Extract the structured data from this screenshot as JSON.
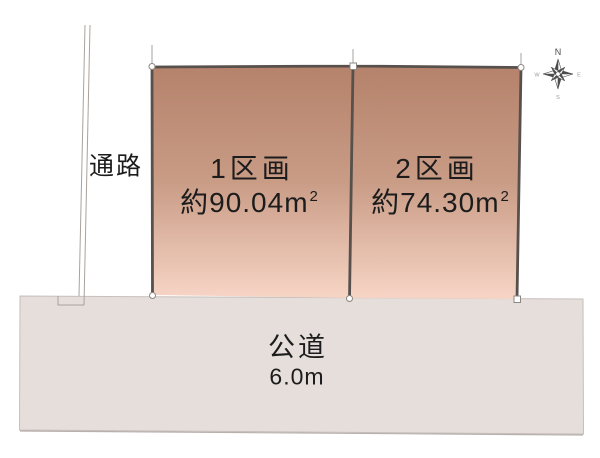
{
  "colors": {
    "background": "#ffffff",
    "plot_top": "#b5826b",
    "plot_mid": "#c99c86",
    "plot_bottom": "#f7d5c6",
    "plot_border": "#57504c",
    "road_fill": "#e5dedb",
    "road_edge": "#c6bfbc",
    "road_shadow": "#b7b0ad",
    "line_light": "#a9a29d",
    "marker_stroke": "#8d8782",
    "text": "#1c1c1c",
    "compass_dark": "#4c4c4c",
    "compass_gray": "#9a9a9a"
  },
  "passage": {
    "label": "通路"
  },
  "plots": [
    {
      "name": "1区画",
      "area_main": "約90.04m",
      "area_sup": "2"
    },
    {
      "name": "2区画",
      "area_main": "約74.30m",
      "area_sup": "2"
    }
  ],
  "road": {
    "name": "公道",
    "width": "6.0m"
  },
  "compass": {
    "icon": "compass-rose-icon",
    "n": "N",
    "e": "E",
    "s": "S",
    "w": "W"
  }
}
